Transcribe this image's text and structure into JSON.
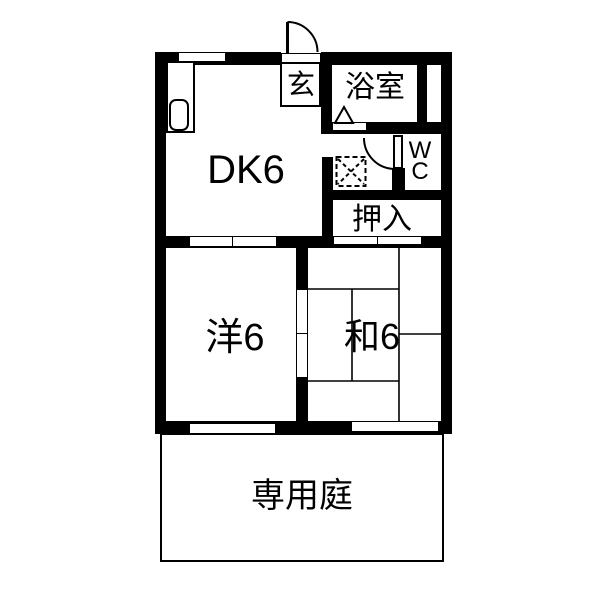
{
  "floor_plan": {
    "rooms": {
      "entrance": {
        "label": "玄"
      },
      "bathroom": {
        "label": "浴室"
      },
      "toilet": {
        "line1": "W",
        "line2": "C"
      },
      "dining_kitchen": {
        "label": "DK6"
      },
      "closet": {
        "label": "押入"
      },
      "western_room": {
        "label": "洋6"
      },
      "japanese_room": {
        "label": "和6"
      },
      "garden": {
        "label": "専用庭"
      }
    },
    "colors": {
      "wall": "#000000",
      "floor": "#ffffff",
      "line": "#000000"
    }
  }
}
